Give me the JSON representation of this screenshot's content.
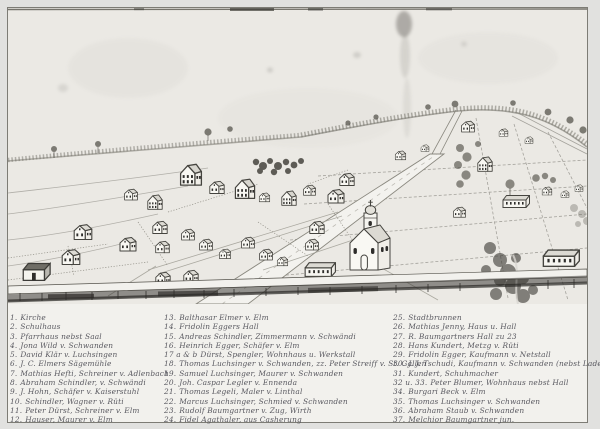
{
  "image": {
    "kind": "black-and-white photograph of a hand-drawn bird's-eye view of a village",
    "scene_description": "Pencil drawing: cluster of small gabled houses at left and center, church with domed tower at center, open fenced field plots with scattered farm buildings at right, wooded ridge and tree line on the horizon, a wide road running diagonally from the bottom edge into the village, a dark fence/road band along the bottom, brushy ravine at lower right, ink smudge at top center.",
    "legend_title": ""
  },
  "colors": {
    "paper": "#ebe9e4",
    "legend_paper": "#f2f1ed",
    "margin": "#e1e1df",
    "pencil": "#6f6d66",
    "ink": "#3f3f48",
    "dark_band": "#34322e"
  },
  "legend": {
    "columns": [
      {
        "entries": [
          {
            "n": "1.",
            "t": "Kirche"
          },
          {
            "n": "2.",
            "t": "Schulhaus"
          },
          {
            "n": "3.",
            "t": "Pfarrhaus nebst Saal"
          },
          {
            "n": "4.",
            "t": "Jona Wild v. Schwanden"
          },
          {
            "n": "5.",
            "t": "David Klär v. Luchsingen"
          },
          {
            "n": "6.",
            "t": "J. C. Elmers Sägemühle"
          },
          {
            "n": "7.",
            "t": "Mathias Hefti, Schreiner v. Adlenbach"
          },
          {
            "n": "8.",
            "t": "Abraham Schindler, v. Schwändi"
          },
          {
            "n": "9.",
            "t": "J. Hohn, Schäfer v. Kaiserstuhl"
          },
          {
            "n": "10.",
            "t": "Schindler, Wagner v. Rüti"
          },
          {
            "n": "11.",
            "t": "Peter Dürst, Schreiner v. Elm"
          },
          {
            "n": "12.",
            "t": "Hauser, Maurer v. Elm"
          }
        ]
      },
      {
        "entries": [
          {
            "n": "13.",
            "t": "Balthasar Elmer v. Elm"
          },
          {
            "n": "14.",
            "t": "Fridolin Eggers Hall"
          },
          {
            "n": "15.",
            "t": "Andreas Schindler, Zimmermann v. Schwändi"
          },
          {
            "n": "16.",
            "t": "Heinrich Egger, Schäfer v. Elm"
          },
          {
            "n": "17 a & b",
            "t": "Dürst, Spengler, Wohnhaus u. Werkstall"
          },
          {
            "n": "18.",
            "t": "Thomas Luchsinger v. Schwanden, zz. Peter Streiff v. St. Gallen"
          },
          {
            "n": "19.",
            "t": "Samuel Luchsinger, Maurer v. Schwanden"
          },
          {
            "n": "20.",
            "t": "Joh. Caspar Legler v. Ennenda"
          },
          {
            "n": "21.",
            "t": "Thomas Legeli, Maler v. Linthal"
          },
          {
            "n": "22.",
            "t": "Marcus Luchsinger, Schmied v. Schwanden"
          },
          {
            "n": "23.",
            "t": "Rudolf Baumgartner v. Zug, Wirth"
          },
          {
            "n": "24.",
            "t": "Fidel Agathaler, aus Casherung"
          }
        ]
      },
      {
        "entries": [
          {
            "n": "25.",
            "t": "Stadtbrunnen"
          },
          {
            "n": "26.",
            "t": "Mathias Jenny, Haus u. Hall"
          },
          {
            "n": "27.",
            "t": "R. Baumgartners Hall zu 23"
          },
          {
            "n": "28.",
            "t": "Hans Kundert, Metzg v. Rüti"
          },
          {
            "n": "29.",
            "t": "Fridolin Egger, Kaufmann v. Netstall"
          },
          {
            "n": "30.",
            "t": "J. J. Tschudi, Kaufmann v. Schwanden (nebst Laden Frid. Egger)"
          },
          {
            "n": "31.",
            "t": "Kundert, Schuhmacher"
          },
          {
            "n": "32 u. 33.",
            "t": "Peter Blumer, Wohnhaus nebst Hall"
          },
          {
            "n": "34.",
            "t": "Burgari Beck v. Elm"
          },
          {
            "n": "35.",
            "t": "Thomas Luchsinger v. Schwanden"
          },
          {
            "n": "36.",
            "t": "Abraham Staub v. Schwanden"
          },
          {
            "n": "37.",
            "t": "Melchior Baumgartner jun."
          }
        ]
      }
    ]
  }
}
